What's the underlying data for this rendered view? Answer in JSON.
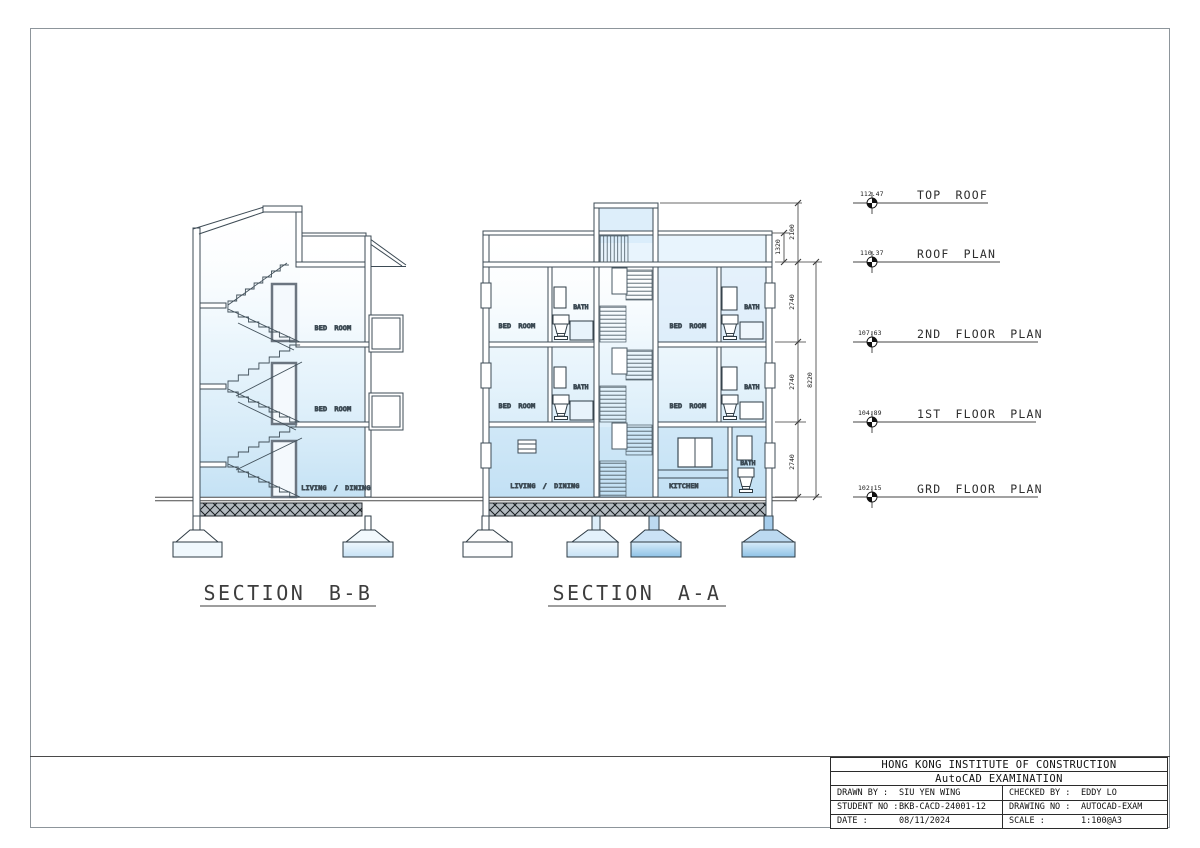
{
  "sections": {
    "b": {
      "title": "SECTION B-B"
    },
    "a": {
      "title": "SECTION A-A"
    }
  },
  "labels": {
    "bed_room": "BED ROOM",
    "bath": "BATH",
    "living_dining": "LIVING / DINING",
    "kitchen": "KITCHEN"
  },
  "levels": [
    {
      "elevation": "112.47",
      "name": "TOP ROOF"
    },
    {
      "elevation": "110.37",
      "name": "ROOF PLAN"
    },
    {
      "elevation": "107.63",
      "name": "2ND FLOOR PLAN"
    },
    {
      "elevation": "104.89",
      "name": "1ST FLOOR PLAN"
    },
    {
      "elevation": "102.15",
      "name": "GRD FLOOR PLAN"
    }
  ],
  "dimensions": {
    "top_roof": "2100",
    "parapet": "1320",
    "floor_height": "2740",
    "overall": "8220"
  },
  "colors": {
    "wash_blue": "#a9d4ef",
    "line": "#3d4b55",
    "hatch_bg": "#b3bac0"
  },
  "title_block": {
    "institute": "HONG KONG INSTITUTE OF CONSTRUCTION",
    "exam": "AutoCAD EXAMINATION",
    "drawn_by_label": "DRAWN BY :",
    "drawn_by": "SIU YEN WING",
    "checked_by_label": "CHECKED BY :",
    "checked_by": "EDDY LO",
    "student_no_label": "STUDENT NO :",
    "student_no": "BKB-CACD-24001-12",
    "drawing_no_label": "DRAWING NO :",
    "drawing_no": "AUTOCAD-EXAM",
    "date_label": "DATE :",
    "date": "08/11/2024",
    "scale_label": "SCALE :",
    "scale": "1:100@A3"
  }
}
